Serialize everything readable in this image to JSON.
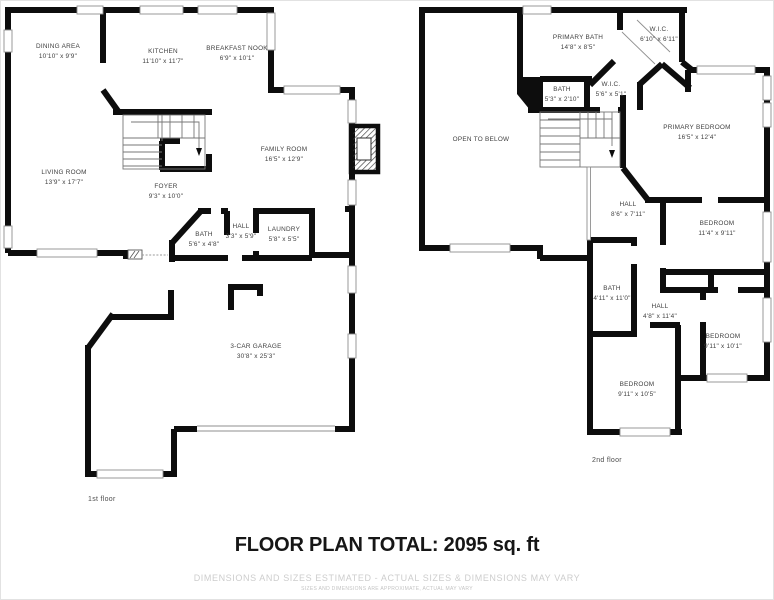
{
  "footer": {
    "total": "FLOOR PLAN TOTAL: 2095 sq. ft",
    "disclaimer1": "DIMENSIONS AND SIZES ESTIMATED - ACTUAL SIZES & DIMENSIONS MAY VARY",
    "disclaimer2": "SIZES AND DIMENSIONS ARE APPROXIMATE, ACTUAL MAY VARY"
  },
  "colors": {
    "wall": "#0d0d0d",
    "label": "#3f3f3f",
    "muted": "#cdcdcd",
    "window_line": "#8f8f8f"
  },
  "floors": [
    {
      "caption": "1st floor",
      "caption_pos": {
        "x": 88,
        "y": 496
      },
      "rooms": [
        {
          "name": "DINING AREA",
          "dims": "10'10\" x 9'9\"",
          "x": 58,
          "y": 52
        },
        {
          "name": "KITCHEN",
          "dims": "11'10\" x 11'7\"",
          "x": 163,
          "y": 57
        },
        {
          "name": "BREAKFAST NOOK",
          "dims": "6'9\" x 10'1\"",
          "x": 237,
          "y": 54
        },
        {
          "name": "LIVING ROOM",
          "dims": "13'9\" x 17'7\"",
          "x": 64,
          "y": 178
        },
        {
          "name": "FOYER",
          "dims": "9'3\" x 10'0\"",
          "x": 166,
          "y": 192
        },
        {
          "name": "FAMILY ROOM",
          "dims": "16'5\" x 12'9\"",
          "x": 284,
          "y": 155
        },
        {
          "name": "BATH",
          "dims": "5'6\" x 4'8\"",
          "x": 204,
          "y": 240
        },
        {
          "name": "HALL",
          "dims": "3'3\" x 5'9\"",
          "x": 241,
          "y": 232
        },
        {
          "name": "LAUNDRY",
          "dims": "5'8\" x 5'5\"",
          "x": 284,
          "y": 235
        },
        {
          "name": "3-CAR GARAGE",
          "dims": "30'8\" x 25'3\"",
          "x": 256,
          "y": 352
        }
      ]
    },
    {
      "caption": "2nd floor",
      "caption_pos": {
        "x": 592,
        "y": 457
      },
      "rooms": [
        {
          "name": "PRIMARY BATH",
          "dims": "14'8\" x 8'5\"",
          "x": 578,
          "y": 43
        },
        {
          "name": "W.I.C.",
          "dims": "6'10\" x 6'11\"",
          "x": 659,
          "y": 35
        },
        {
          "name": "BATH",
          "dims": "5'3\" x 2'10\"",
          "x": 562,
          "y": 95
        },
        {
          "name": "W.I.C.",
          "dims": "5'6\" x 5'1\"",
          "x": 611,
          "y": 90
        },
        {
          "name": "OPEN TO BELOW",
          "dims": "",
          "x": 481,
          "y": 140
        },
        {
          "name": "PRIMARY BEDROOM",
          "dims": "16'5\" x 12'4\"",
          "x": 697,
          "y": 133
        },
        {
          "name": "HALL",
          "dims": "8'6\" x 7'11\"",
          "x": 628,
          "y": 210
        },
        {
          "name": "BEDROOM",
          "dims": "11'4\" x 9'11\"",
          "x": 717,
          "y": 229
        },
        {
          "name": "BATH",
          "dims": "4'11\" x 11'0\"",
          "x": 612,
          "y": 294
        },
        {
          "name": "HALL",
          "dims": "4'8\" x 11'4\"",
          "x": 660,
          "y": 312
        },
        {
          "name": "BEDROOM",
          "dims": "9'11\" x 10'1\"",
          "x": 723,
          "y": 342
        },
        {
          "name": "BEDROOM",
          "dims": "9'11\" x 10'5\"",
          "x": 637,
          "y": 390
        }
      ]
    }
  ]
}
